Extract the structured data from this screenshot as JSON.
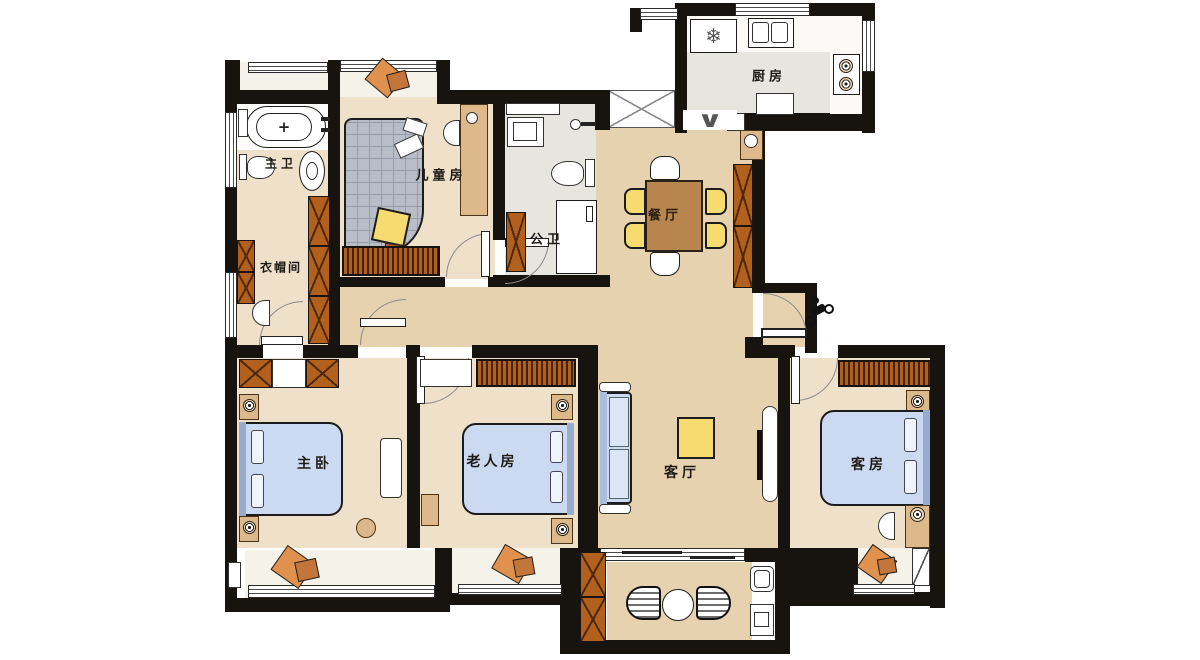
{
  "meta": {
    "type": "apartment-floor-plan",
    "style": "top-down color rendering"
  },
  "rooms": {
    "master_bath": {
      "label": "主卫"
    },
    "kids_room": {
      "label": "儿童房"
    },
    "public_bath": {
      "label": "公卫"
    },
    "closet": {
      "label": "衣帽间"
    },
    "kitchen": {
      "label": "厨房"
    },
    "dining": {
      "label": "餐厅"
    },
    "master_bedroom": {
      "label": "主卧"
    },
    "elderly_room": {
      "label": "老人房"
    },
    "living": {
      "label": "客厅"
    },
    "guest_room": {
      "label": "客房"
    }
  },
  "glyphs": {
    "snowflake": "❄",
    "tub_cross": "+",
    "folding_door": "∨"
  },
  "colors": {
    "wall": "#17130e",
    "wood_floor": "#e7d2b0",
    "bedroom_floor": "#efe1c9",
    "tile_floor": "#e6e5e0",
    "bay_seat": "#f5f2ea",
    "bed_blue": "#cbd9f1",
    "accent_yellow": "#f6dc70",
    "cabinet_orange": "#b2601e",
    "cushion_orange": "#e0914e"
  }
}
